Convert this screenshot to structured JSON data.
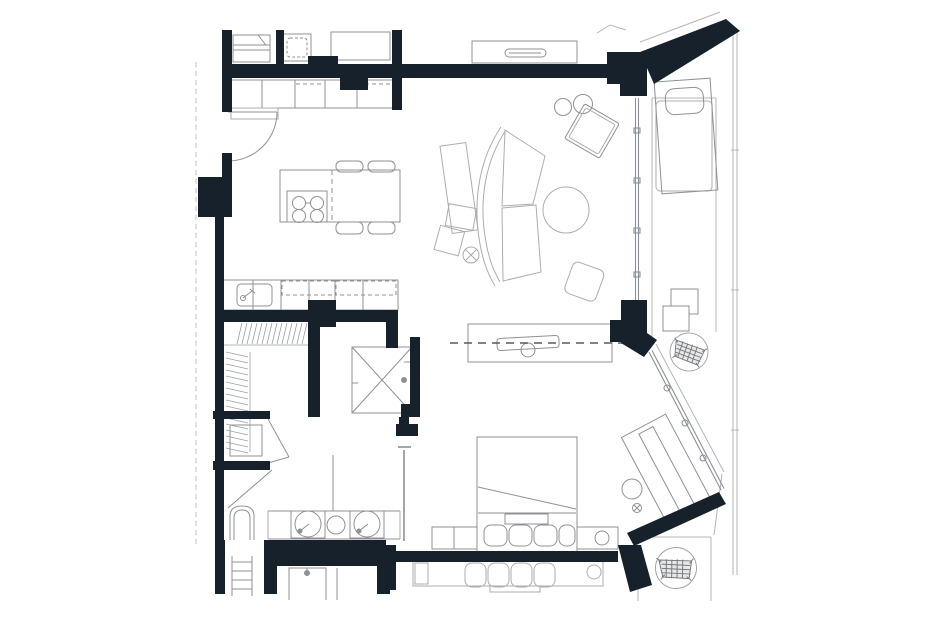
{
  "meta": {
    "type": "apartment-floor-plan",
    "canvas": {
      "width": 940,
      "height": 627
    },
    "visible_text": []
  },
  "colors": {
    "background": "#ffffff",
    "wall": "#16212b",
    "furniture": "#8d9196",
    "light": "#aaadb1",
    "window": "#8a9099",
    "hatch": "#9aa0a6",
    "terrace": "#b2b6ba",
    "dashline": "#565b61",
    "propertyline": "#bcc0c4",
    "white": "#ffffff"
  },
  "inventory": {
    "kitchen": [
      "stacked-appliance",
      "washer",
      "tall-cabinet",
      "wall-counter",
      "upper-cabinets-dashed",
      "sink",
      "island-cooktop-4-burners",
      "dining-table",
      "chairs-x4",
      "entry-door-swing"
    ],
    "living": [
      "console-table",
      "armchair",
      "side-table-circles-x2",
      "curved-sectional-sofa",
      "sofa-side-table-x",
      "round-coffee-table",
      "ottoman",
      "tv-sideboard",
      "tv-dashed-axis"
    ],
    "core": [
      "walk-in-closet-hatching",
      "shaft-x-box",
      "wc-fixture",
      "door-swings"
    ],
    "bathroom": [
      "toilet",
      "double-vanity-counter",
      "round-basins-x2",
      "vessel-circle",
      "towel-ladder",
      "shower-below",
      "bath-door"
    ],
    "bedroom": [
      "bed",
      "pillows-x4",
      "blanket-fold",
      "platform-bench",
      "bench-lamp-circle",
      "door-leaf",
      "desk-angled",
      "desk-shelf",
      "stool",
      "neighbor-bed-row"
    ],
    "terrace": [
      "lounge-chair",
      "lounge-pillow",
      "side-squares-x2",
      "woven-chair-top",
      "woven-chair-bottom",
      "deck-edges",
      "balcony-parapet"
    ],
    "structure": [
      "exterior-walls",
      "interior-walls",
      "window-wall-right",
      "window-wall-diagonal",
      "diagonal-party-walls",
      "property-dashed-line"
    ]
  }
}
